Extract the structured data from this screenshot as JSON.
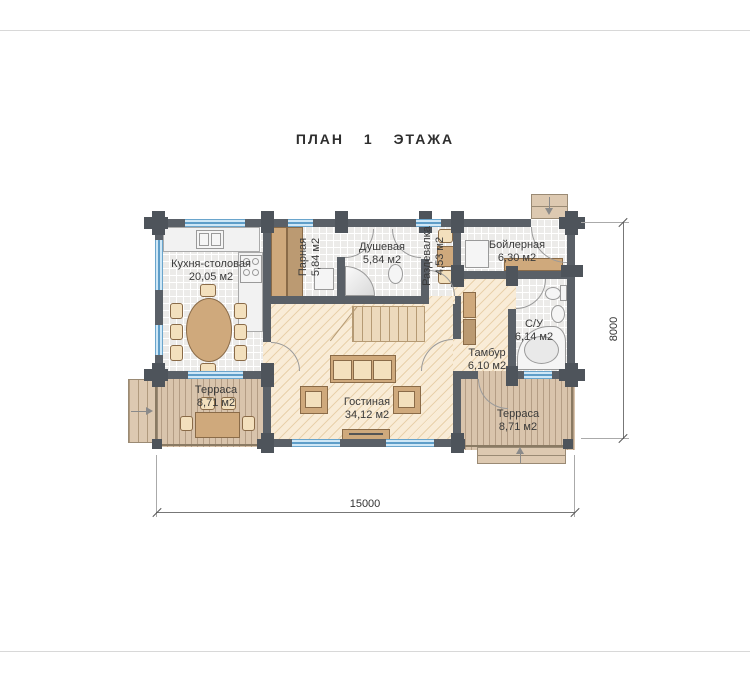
{
  "title": "ПЛАН 1 ЭТАЖА",
  "rooms": {
    "kitchen": {
      "name": "Кухня-столовая",
      "area": "20,05 м2"
    },
    "sauna": {
      "name": "Парная",
      "area": "5,84 м2"
    },
    "shower": {
      "name": "Душевая",
      "area": "5,84 м2"
    },
    "dressing": {
      "name": "Раздевалка",
      "area": "4,53 м2"
    },
    "boiler": {
      "name": "Бойлерная",
      "area": "6,30 м2"
    },
    "wc": {
      "name": "С/У",
      "area": "6,14 м2"
    },
    "vestibule": {
      "name": "Тамбур",
      "area": "6,10 м2"
    },
    "living": {
      "name": "Гостиная",
      "area": "34,12 м2"
    },
    "terrace_left": {
      "name": "Терраса",
      "area": "8,71 м2"
    },
    "terrace_right": {
      "name": "Терраса",
      "area": "8,71 м2"
    }
  },
  "dimensions": {
    "width_mm": "15000",
    "height_mm": "8000"
  },
  "icons": {
    "entry_left": "arrow-right",
    "entry_boiler": "arrow-down",
    "entry_terrace": "arrow-up"
  },
  "colors": {
    "wall": "#5a6067",
    "window": "#cfe7f6",
    "tile_floor": "#ecebe9",
    "wood_floor": "#f9ecd7",
    "deck": "#d9c4ac",
    "furniture": "#cfa97c"
  }
}
